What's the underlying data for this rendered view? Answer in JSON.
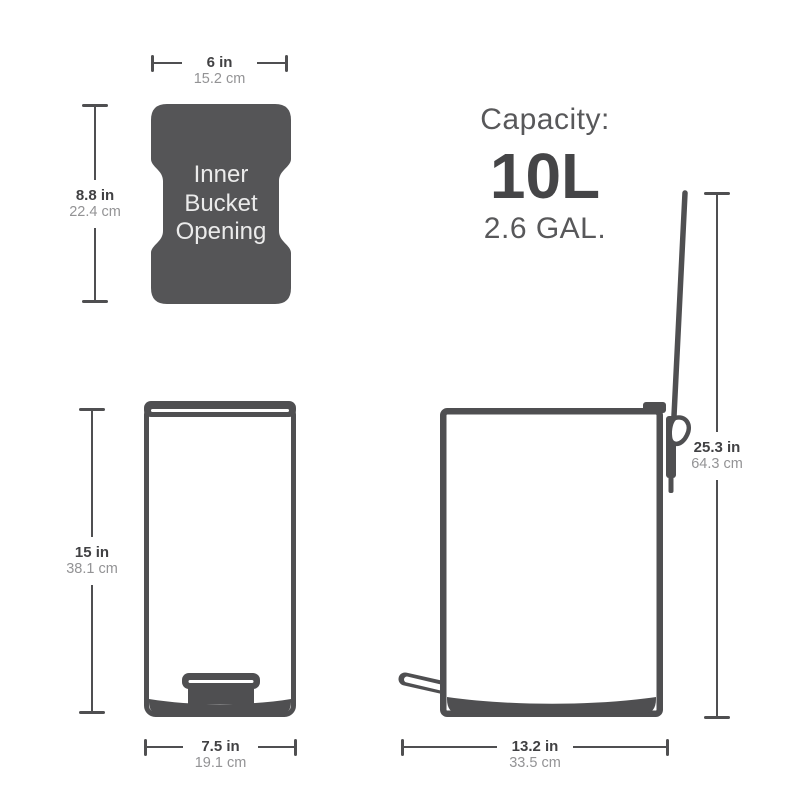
{
  "colors": {
    "ink": "#4f4f51",
    "shape-fill": "#555557",
    "label-bold": "#414143",
    "label-light": "#939395",
    "shape-text": "#ebebeb",
    "capacity-text": "#58585a",
    "capacity-strong": "#454547",
    "background": "#ffffff"
  },
  "inner_bucket": {
    "label": "Inner Bucket Opening",
    "width_in": "6 in",
    "width_cm": "15.2 cm",
    "height_in": "8.8 in",
    "height_cm": "22.4 cm"
  },
  "capacity": {
    "heading": "Capacity:",
    "liters": "10L",
    "gallons": "2.6 GAL."
  },
  "front_view": {
    "height_in": "15 in",
    "height_cm": "38.1 cm",
    "width_in": "7.5 in",
    "width_cm": "19.1 cm"
  },
  "side_view": {
    "height_in": "25.3 in",
    "height_cm": "64.3 cm",
    "depth_in": "13.2 in",
    "depth_cm": "33.5 cm"
  }
}
